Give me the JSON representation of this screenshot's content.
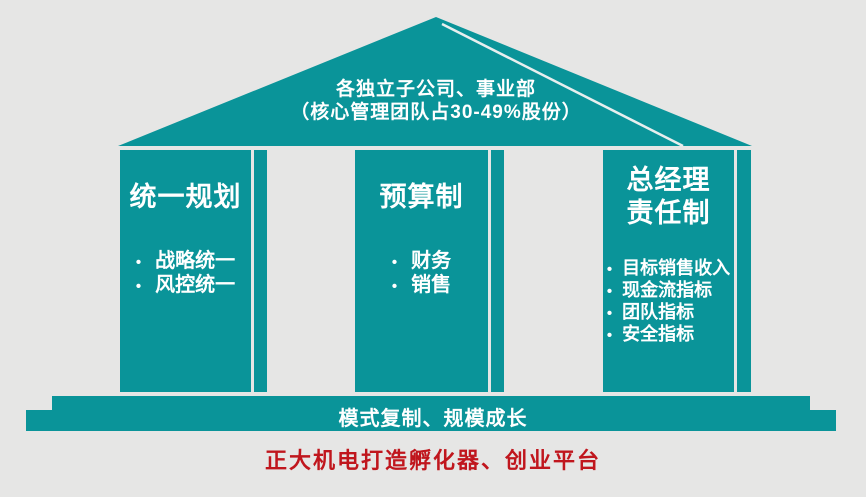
{
  "colors": {
    "background": "#e6e6e5",
    "teal": "#0a9499",
    "white_text": "#ffffff",
    "red_text": "#c0161d",
    "roof_highlight_line": "#e8efef"
  },
  "bullet_char": "•",
  "roof": {
    "line1": "各独立子公司、事业部",
    "line2": "（核心管理团队占30-49%股份）"
  },
  "pillars": [
    {
      "title_lines": [
        "统一规划"
      ],
      "bullets": [
        "战略统一",
        "风控统一"
      ]
    },
    {
      "title_lines": [
        "预算制"
      ],
      "bullets": [
        "财务",
        "销售"
      ]
    },
    {
      "title_lines": [
        "总经理",
        "责任制"
      ],
      "bullets": [
        "目标销售收入",
        "现金流指标",
        "团队指标",
        "安全指标"
      ]
    }
  ],
  "base": {
    "label": "模式复制、规模成长"
  },
  "caption": {
    "label": "正大机电打造孵化器、创业平台"
  }
}
